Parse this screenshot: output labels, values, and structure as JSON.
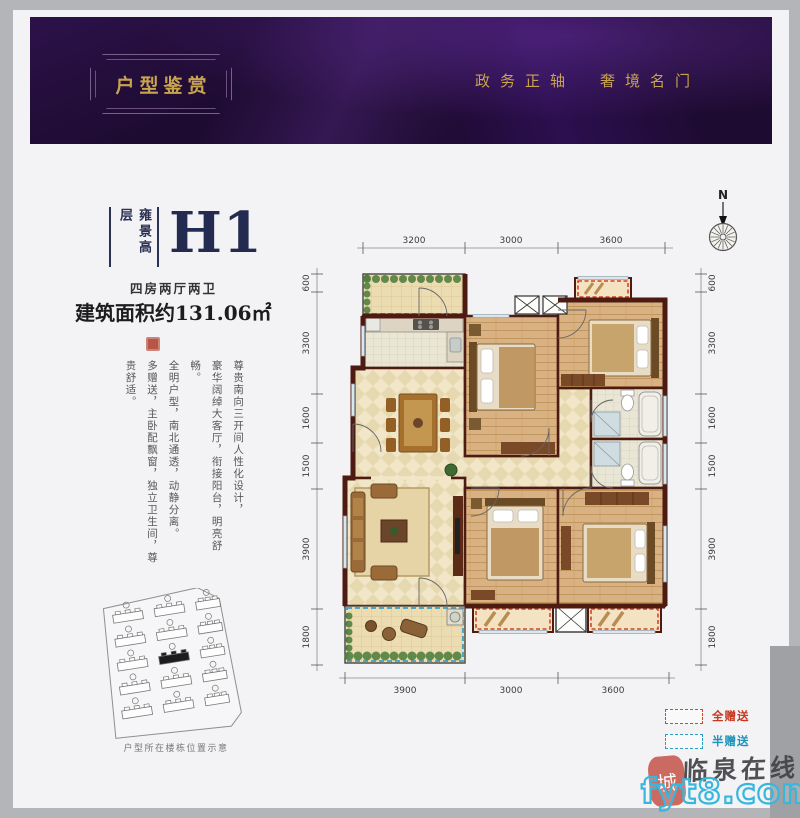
{
  "banner": {
    "badge_title": "户型鉴赏",
    "slogan": "政务正轴　奢境名门"
  },
  "unit": {
    "series": "雍景高层",
    "code": "H1",
    "rooms_label": "四房两厅两卫",
    "area_label": "建筑面积约131.06㎡"
  },
  "description": {
    "line1": "尊贵南向三开间人性化设计，",
    "line2": "豪华阔绰大客厅，衔接阳台，明亮舒畅。",
    "line3": "全明户型，南北通透，动静分离。",
    "line4": "多赠送，主卧配飘窗，独立卫生间，尊贵舒适。"
  },
  "floor_plan": {
    "compass_label": "N",
    "dimensions_top": [
      "3200",
      "3000",
      "3600"
    ],
    "dimensions_bottom": [
      "3900",
      "3000",
      "3600"
    ],
    "dimensions_left": [
      "600",
      "3300",
      "1600",
      "1500",
      "3900",
      "1800"
    ],
    "dimensions_right": [
      "600",
      "3300",
      "1600",
      "1500",
      "3900",
      "1800"
    ]
  },
  "legend": {
    "full_gift": "全赠送",
    "full_gift_color": "#c8371f",
    "half_gift": "半赠送",
    "half_gift_color": "#1d93ba"
  },
  "site_plan": {
    "caption": "户型所在楼栋位置示意"
  },
  "watermark": {
    "seal_char": "城",
    "site_name": "临泉在线",
    "site_url": "fyt8.com"
  },
  "colors": {
    "banner_bg": "#1e0b31",
    "banner_gold": "#c9a44f",
    "navy": "#232c50",
    "wall": "#4d1b12",
    "full_gift_dash": "#d5452b",
    "half_gift_dash": "#2e9fc4"
  }
}
